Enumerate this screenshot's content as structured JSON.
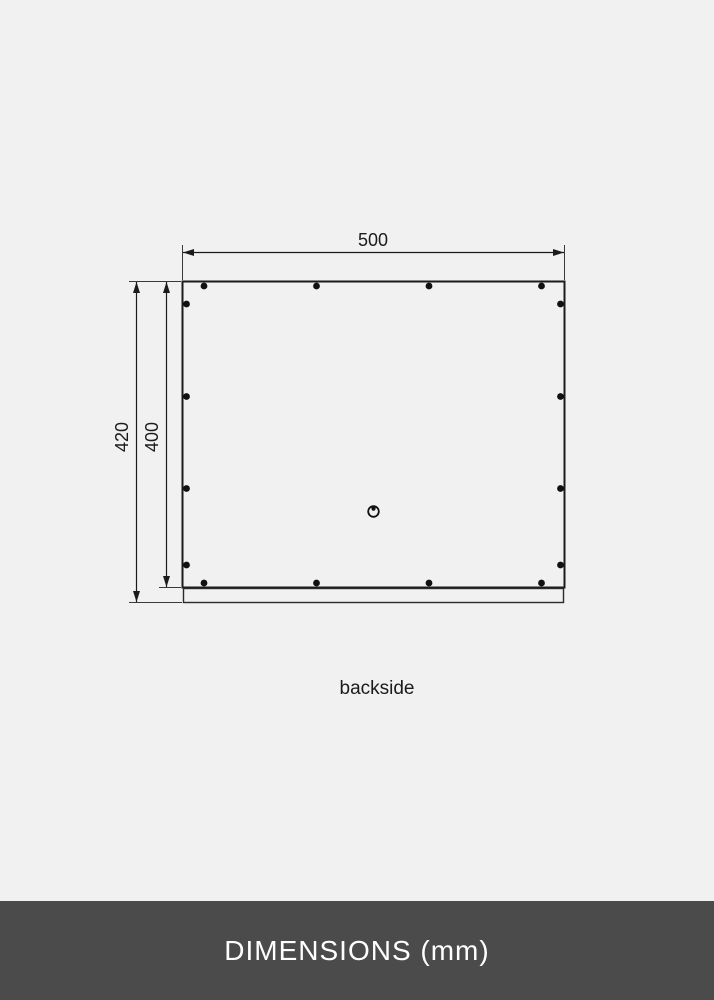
{
  "drawing": {
    "view_label": "backside",
    "dimensions": {
      "width": {
        "value": 500,
        "unit": "mm",
        "label": "500"
      },
      "outer_height": {
        "value": 420,
        "unit": "mm",
        "label": "420"
      },
      "inner_height": {
        "value": 400,
        "unit": "mm",
        "label": "400"
      }
    },
    "features": {
      "fastener_dots_top": 4,
      "fastener_dots_bottom": 4,
      "fastener_dots_left": 4,
      "fastener_dots_right": 4,
      "hanging_hole": "circle-with-dot",
      "hanging_rail": "bottom-strip"
    },
    "colors": {
      "line": "#1b1b1b",
      "background": "#f1f1f1"
    }
  },
  "footer": {
    "title": "DIMENSIONS (mm)",
    "background": "#4b4b4b",
    "text_color": "#ffffff"
  }
}
